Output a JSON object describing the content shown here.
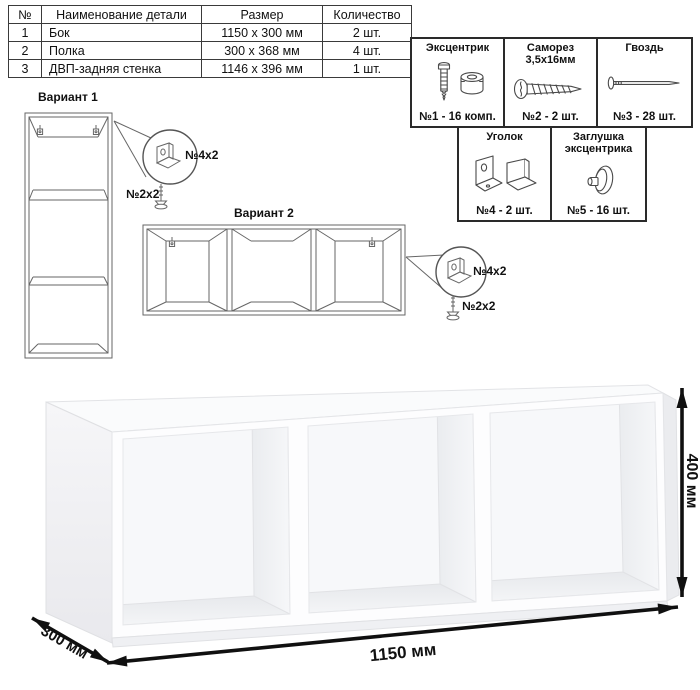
{
  "page": {
    "background": "#ffffff",
    "table_border_color": "#3a3a3a",
    "panel_border_color": "#2a2a2a",
    "drawing_stroke_color": "#666666",
    "dimension_arrow_color": "#101010"
  },
  "parts_table": {
    "headers": [
      "№",
      "Наименование детали",
      "Размер",
      "Количество"
    ],
    "rows": [
      {
        "num": "1",
        "name": "Бок",
        "size": "1150 x 300 мм",
        "qty": "2 шт."
      },
      {
        "num": "2",
        "name": "Полка",
        "size": "300 x 368 мм",
        "qty": "4 шт."
      },
      {
        "num": "3",
        "name": "ДВП-задняя стенка",
        "size": "1146 x 396 мм",
        "qty": "1 шт."
      }
    ]
  },
  "hardware": {
    "items": [
      {
        "title": "Эксцентрик",
        "label": "№1 - 16 комп.",
        "icon": "eccentric-cam-icon"
      },
      {
        "title": "Саморез 3,5х16мм",
        "label": "№2 - 2 шт.",
        "icon": "screw-icon"
      },
      {
        "title": "Гвоздь",
        "label": "№3 - 28 шт.",
        "icon": "nail-icon"
      },
      {
        "title": "Уголок",
        "label": "№4 - 2 шт.",
        "icon": "corner-bracket-icon"
      },
      {
        "title": "Заглушка эксцентрика",
        "label": "№5 - 16 шт.",
        "icon": "cam-cap-icon"
      }
    ]
  },
  "variants": {
    "variant1": {
      "title": "Вариант 1",
      "bracket_label": "№4x2",
      "screw_label": "№2x2"
    },
    "variant2": {
      "title": "Вариант 2",
      "bracket_label": "№4x2",
      "screw_label": "№2x2"
    }
  },
  "dimensions": {
    "width": "1150 мм",
    "height": "400 мм",
    "depth": "300 мм"
  }
}
